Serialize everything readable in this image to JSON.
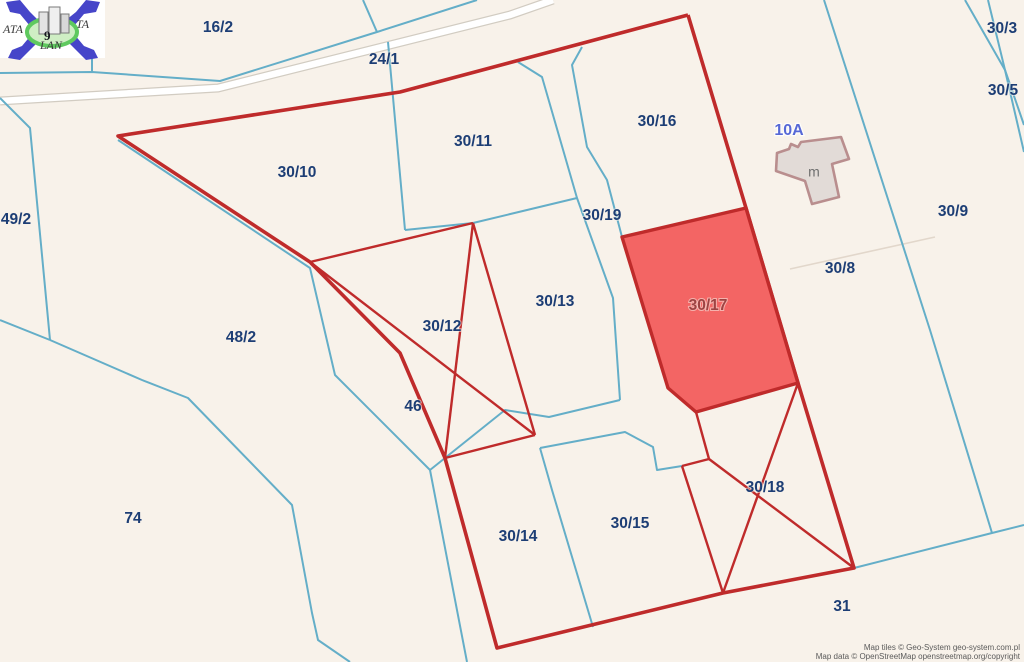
{
  "map": {
    "background": "#f8f2ea",
    "colors": {
      "cadastral_line": "#64aec8",
      "faint_line": "#e2d7cb",
      "red_boundary": "#bf2b2b",
      "highlight_fill": "#f15151",
      "label_navy": "#1d3e75",
      "label_red": "#9e4343",
      "house_label_blue": "#5668d6",
      "road_fill": "#ffffff",
      "road_casing": "#d2ccc2",
      "building_fill": "#e2dbd7",
      "building_stroke": "#b98e8e"
    },
    "attribution": {
      "line1": "Map tiles © Geo-System geo-system.com.pl",
      "line2": "Map data © OpenStreetMap openstreetmap.org/copyright"
    },
    "logo": {
      "text_left": "ATA",
      "text_right": "TA",
      "text_bottom": "LAN",
      "digit": "9"
    },
    "highlight_parcel": {
      "id": "30/17",
      "points": [
        [
          622,
          237
        ],
        [
          746,
          208
        ],
        [
          798,
          383
        ],
        [
          696,
          412
        ],
        [
          668,
          388
        ]
      ]
    },
    "building": {
      "house_no": "10A",
      "label": "m",
      "points": [
        [
          777,
          153
        ],
        [
          789,
          149
        ],
        [
          791,
          144
        ],
        [
          798,
          147
        ],
        [
          801,
          142
        ],
        [
          841,
          137
        ],
        [
          849,
          159
        ],
        [
          832,
          164
        ],
        [
          839,
          197
        ],
        [
          812,
          204
        ],
        [
          805,
          181
        ],
        [
          776,
          171
        ]
      ]
    },
    "road": {
      "path": [
        [
          0,
          101
        ],
        [
          218,
          88
        ],
        [
          510,
          15
        ],
        [
          553,
          0
        ]
      ]
    },
    "red_perimeter": [
      [
        688,
        15
      ],
      [
        400,
        92
      ],
      [
        118,
        136
      ],
      [
        310,
        262
      ],
      [
        400,
        353
      ],
      [
        445,
        458
      ],
      [
        497,
        648
      ],
      [
        723,
        593
      ],
      [
        854,
        568
      ],
      [
        798,
        383
      ],
      [
        746,
        208
      ],
      [
        688,
        15
      ]
    ],
    "red_inner_lines": [
      [
        [
          310,
          262
        ],
        [
          473,
          223
        ]
      ],
      [
        [
          473,
          223
        ],
        [
          445,
          458
        ]
      ],
      [
        [
          473,
          223
        ],
        [
          535,
          435
        ]
      ],
      [
        [
          310,
          262
        ],
        [
          535,
          435
        ]
      ],
      [
        [
          445,
          458
        ],
        [
          535,
          435
        ]
      ],
      [
        [
          696,
          412
        ],
        [
          709,
          459
        ]
      ],
      [
        [
          709,
          459
        ],
        [
          682,
          466
        ]
      ],
      [
        [
          682,
          466
        ],
        [
          723,
          593
        ]
      ],
      [
        [
          709,
          459
        ],
        [
          854,
          568
        ]
      ],
      [
        [
          798,
          383
        ],
        [
          723,
          593
        ]
      ]
    ],
    "cyan_lines": [
      {
        "name": "road-parallel-boundary",
        "points": [
          [
            0,
            73
          ],
          [
            92,
            72
          ],
          [
            220,
            81
          ],
          [
            377,
            32
          ],
          [
            477,
            0
          ]
        ]
      },
      {
        "name": "north-branch",
        "points": [
          [
            363,
            0
          ],
          [
            377,
            32
          ]
        ]
      },
      {
        "name": "logo-stub",
        "points": [
          [
            92,
            55
          ],
          [
            92,
            72
          ]
        ]
      },
      {
        "name": "west-boundary-49-2",
        "points": [
          [
            0,
            98
          ],
          [
            30,
            128
          ],
          [
            50,
            340
          ]
        ]
      },
      {
        "name": "west-edge-branch",
        "points": [
          [
            0,
            320
          ],
          [
            50,
            340
          ]
        ]
      },
      {
        "name": "parcel-74-curve",
        "points": [
          [
            50,
            340
          ],
          [
            142,
            380
          ],
          [
            188,
            398
          ],
          [
            292,
            505
          ],
          [
            312,
            613
          ],
          [
            318,
            640
          ],
          [
            350,
            662
          ]
        ]
      },
      {
        "name": "boundary-48-2",
        "points": [
          [
            118,
            140
          ],
          [
            310,
            268
          ],
          [
            335,
            375
          ],
          [
            430,
            470
          ],
          [
            467,
            662
          ]
        ]
      },
      {
        "name": "boundary-30-13-south",
        "points": [
          [
            620,
            400
          ],
          [
            549,
            417
          ],
          [
            505,
            410
          ],
          [
            430,
            470
          ]
        ]
      },
      {
        "name": "driveway-left",
        "points": [
          [
            518,
            62
          ],
          [
            542,
            77
          ],
          [
            577,
            198
          ],
          [
            613,
            298
          ],
          [
            620,
            400
          ]
        ]
      },
      {
        "name": "boundary-30-11-30-13",
        "points": [
          [
            405,
            230
          ],
          [
            473,
            223
          ],
          [
            577,
            198
          ]
        ]
      },
      {
        "name": "boundary-30-10-30-11",
        "points": [
          [
            388,
            42
          ],
          [
            405,
            230
          ]
        ]
      },
      {
        "name": "driveway-right",
        "points": [
          [
            582,
            47
          ],
          [
            572,
            65
          ],
          [
            587,
            147
          ],
          [
            607,
            180
          ],
          [
            622,
            237
          ]
        ]
      },
      {
        "name": "boundary-30-9-west",
        "points": [
          [
            824,
            0
          ],
          [
            930,
            330
          ],
          [
            992,
            533
          ]
        ]
      },
      {
        "name": "boundary-31-north",
        "points": [
          [
            854,
            568
          ],
          [
            992,
            533
          ],
          [
            1024,
            525
          ]
        ]
      },
      {
        "name": "strip-30-3-a",
        "points": [
          [
            965,
            0
          ],
          [
            1005,
            70
          ],
          [
            1024,
            125
          ]
        ]
      },
      {
        "name": "strip-30-3-b",
        "points": [
          [
            988,
            0
          ],
          [
            1005,
            70
          ],
          [
            1024,
            152
          ]
        ]
      },
      {
        "name": "neck-30-15",
        "points": [
          [
            540,
            448
          ],
          [
            625,
            432
          ],
          [
            653,
            447
          ],
          [
            657,
            470
          ],
          [
            682,
            466
          ]
        ]
      },
      {
        "name": "divider-30-14-30-15",
        "points": [
          [
            540,
            448
          ],
          [
            552,
            490
          ],
          [
            593,
            627
          ]
        ]
      }
    ],
    "faint_lines": [
      {
        "name": "boundary-30-8-30-9",
        "points": [
          [
            790,
            269
          ],
          [
            935,
            237
          ]
        ]
      }
    ],
    "parcel_labels": [
      {
        "text": "16/2",
        "x": 218,
        "y": 28,
        "kind": "navy"
      },
      {
        "text": "24/1",
        "x": 384,
        "y": 60,
        "kind": "navy"
      },
      {
        "text": "30/11",
        "x": 473,
        "y": 142,
        "kind": "navy"
      },
      {
        "text": "30/16",
        "x": 657,
        "y": 122,
        "kind": "navy"
      },
      {
        "text": "30/3",
        "x": 1002,
        "y": 29,
        "kind": "navy"
      },
      {
        "text": "30/5",
        "x": 1003,
        "y": 91,
        "kind": "navy"
      },
      {
        "text": "30/10",
        "x": 297,
        "y": 173,
        "kind": "navy"
      },
      {
        "text": "49/2",
        "x": 16,
        "y": 220,
        "kind": "navy"
      },
      {
        "text": "30/19",
        "x": 602,
        "y": 216,
        "kind": "navy"
      },
      {
        "text": "30/9",
        "x": 953,
        "y": 212,
        "kind": "navy"
      },
      {
        "text": "30/8",
        "x": 840,
        "y": 269,
        "kind": "navy"
      },
      {
        "text": "30/13",
        "x": 555,
        "y": 302,
        "kind": "navy"
      },
      {
        "text": "30/17",
        "x": 708,
        "y": 306,
        "kind": "red"
      },
      {
        "text": "30/12",
        "x": 442,
        "y": 327,
        "kind": "navy"
      },
      {
        "text": "48/2",
        "x": 241,
        "y": 338,
        "kind": "navy"
      },
      {
        "text": "46",
        "x": 413,
        "y": 407,
        "kind": "navy"
      },
      {
        "text": "74",
        "x": 133,
        "y": 519,
        "kind": "navy"
      },
      {
        "text": "30/14",
        "x": 518,
        "y": 537,
        "kind": "navy"
      },
      {
        "text": "30/15",
        "x": 630,
        "y": 524,
        "kind": "navy"
      },
      {
        "text": "30/18",
        "x": 765,
        "y": 488,
        "kind": "navy"
      },
      {
        "text": "31",
        "x": 842,
        "y": 607,
        "kind": "navy"
      },
      {
        "text": "10A",
        "x": 789,
        "y": 131,
        "kind": "house"
      },
      {
        "text": "m",
        "x": 814,
        "y": 173,
        "kind": "bld"
      }
    ]
  }
}
